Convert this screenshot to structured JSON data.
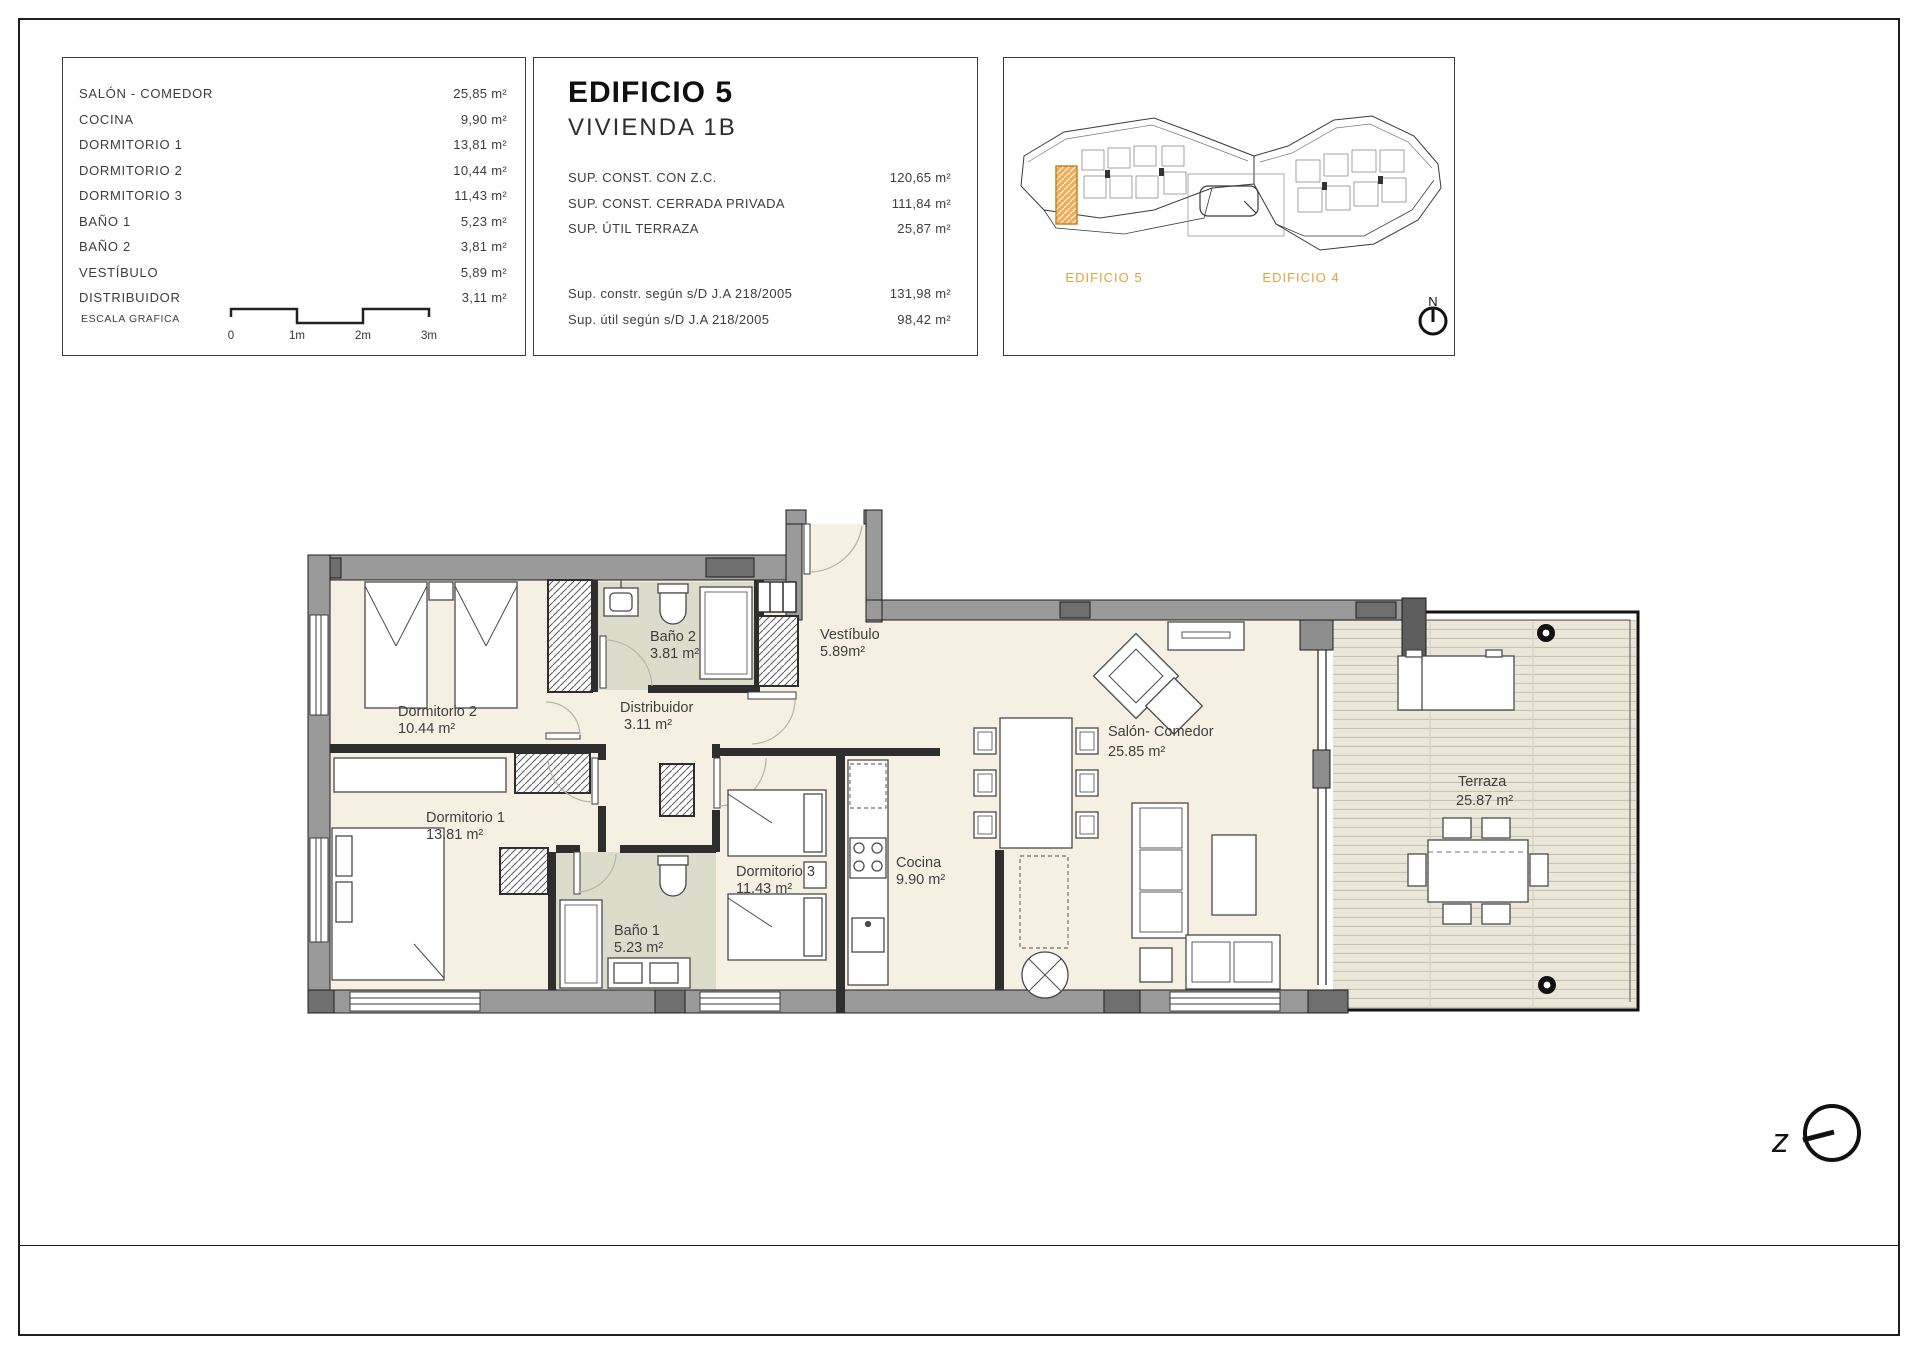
{
  "colors": {
    "accent_orange": "#E2A23C",
    "wall_gray": "#9a9a9a",
    "wall_dark": "#6f6f6f",
    "partition": "#2e2e2e",
    "room_cream": "#f5f0e2",
    "bath_green": "#dbddca",
    "deck_beige": "#eae7d8"
  },
  "area_table": {
    "rows": [
      {
        "label": "SALÓN - COMEDOR",
        "value": "25,85 m²"
      },
      {
        "label": "COCINA",
        "value": "9,90 m²"
      },
      {
        "label": "DORMITORIO 1",
        "value": "13,81 m²"
      },
      {
        "label": "DORMITORIO 2",
        "value": "10,44 m²"
      },
      {
        "label": "DORMITORIO 3",
        "value": "11,43 m²"
      },
      {
        "label": "BAÑO 1",
        "value": "5,23 m²"
      },
      {
        "label": "BAÑO 2",
        "value": "3,81 m²"
      },
      {
        "label": "VESTÍBULO",
        "value": "5,89 m²"
      },
      {
        "label": "DISTRIBUIDOR",
        "value": "3,11 m²"
      }
    ],
    "scale_label": "ESCALA GRAFICA",
    "scale_ticks": [
      "0",
      "1m",
      "2m",
      "3m"
    ]
  },
  "info_panel": {
    "title": "EDIFICIO 5",
    "subtitle": "VIVIENDA 1B",
    "rows": [
      {
        "label": "SUP. CONST. CON Z.C.",
        "value": "120,65 m²"
      },
      {
        "label": "SUP. CONST. CERRADA PRIVADA",
        "value": "111,84 m²"
      },
      {
        "label": "SUP. ÚTIL TERRAZA",
        "value": "25,87 m²"
      }
    ],
    "rows2": [
      {
        "label": "Sup. constr. según s/D J.A 218/2005",
        "value": "131,98 m²"
      },
      {
        "label": "Sup. útil según s/D J.A 218/2005",
        "value": "98,42 m²"
      }
    ]
  },
  "site_panel": {
    "left_building": "EDIFICIO 5",
    "right_building": "EDIFICIO 4",
    "north": "N"
  },
  "floor_plan": {
    "rooms": [
      {
        "name": "Dormitorio 2",
        "area": "10.44 m²"
      },
      {
        "name": "Baño 2",
        "area": "3.81 m²"
      },
      {
        "name": "Distribuidor",
        "area": "3.11 m²"
      },
      {
        "name": "Vestíbulo",
        "area": "5.89m²"
      },
      {
        "name": "Dormitorio 1",
        "area": "13.81 m²"
      },
      {
        "name": "Baño 1",
        "area": "5.23 m²"
      },
      {
        "name": "Dormitorio 3",
        "area": "11.43 m²"
      },
      {
        "name": "Cocina",
        "area": "9.90 m²"
      },
      {
        "name": "Salón- Comedor",
        "area": "25.85 m²"
      },
      {
        "name": "Terraza",
        "area": "25.87 m²"
      }
    ],
    "orientation_letter": "z"
  }
}
